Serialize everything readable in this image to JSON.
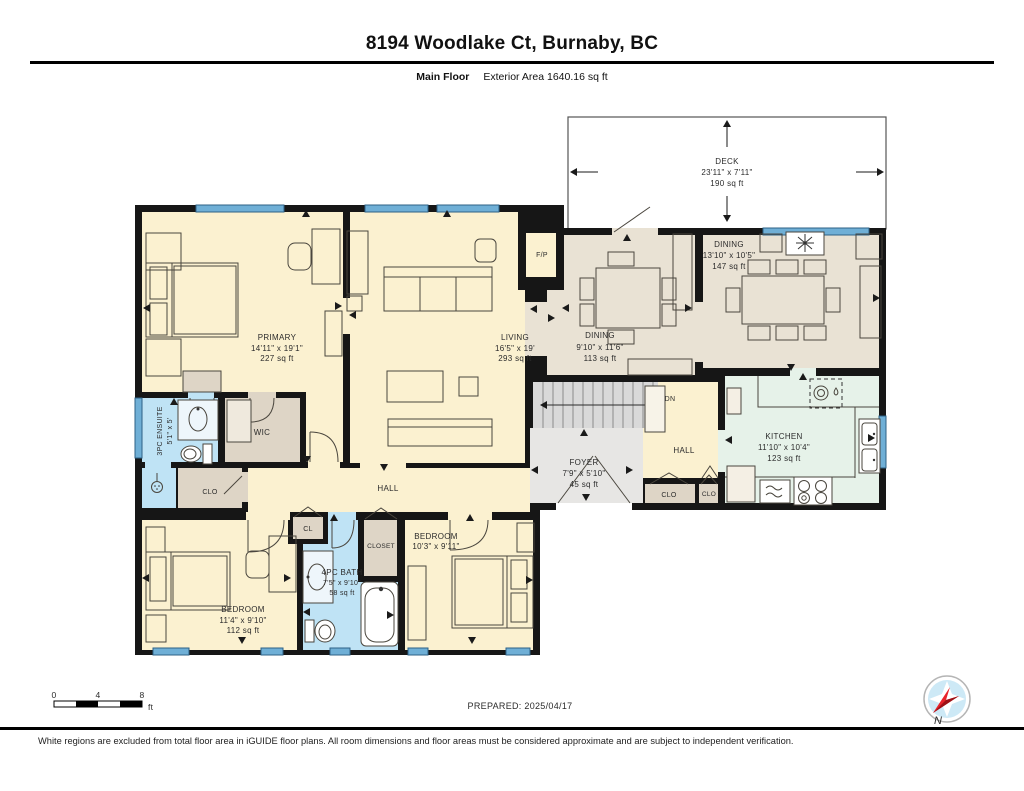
{
  "header": {
    "title": "8194 Woodlake Ct, Burnaby, BC",
    "floor_label": "Main Floor",
    "area_label": "Exterior Area 1640.16 sq ft"
  },
  "rooms": {
    "deck": {
      "name": "DECK",
      "dims": "23'11\" x 7'11\"",
      "area": "190 sq ft"
    },
    "primary": {
      "name": "PRIMARY",
      "dims": "14'11\" x 19'1\"",
      "area": "227 sq ft"
    },
    "living": {
      "name": "LIVING",
      "dims": "16'5\" x 19'",
      "area": "293 sq ft"
    },
    "dining_small": {
      "name": "DINING",
      "dims": "9'10\" x 11'6\"",
      "area": "113 sq ft"
    },
    "dining_large": {
      "name": "DINING",
      "dims": "13'10\" x 10'5\"",
      "area": "147 sq ft"
    },
    "kitchen": {
      "name": "KITCHEN",
      "dims": "11'10\" x 10'4\"",
      "area": "123 sq ft"
    },
    "foyer": {
      "name": "FOYER",
      "dims": "7'9\" x 5'10\"",
      "area": "45 sq ft"
    },
    "bedroom_left": {
      "name": "BEDROOM",
      "dims": "11'4\" x 9'10\"",
      "area": "112 sq ft"
    },
    "bedroom_right": {
      "name": "BEDROOM",
      "dims": "10'3\" x 9'11\""
    },
    "bath": {
      "name": "4PC BATH",
      "dims": "7'5\" x 9'10\"",
      "area": "58 sq ft"
    },
    "ensuite": {
      "name": "3PC ENSUITE",
      "dims": "5'1\" x 5'"
    },
    "wic": {
      "name": "WIC"
    },
    "hall_main": {
      "name": "HALL"
    },
    "hall_right": {
      "name": "HALL"
    },
    "clo_left": {
      "name": "CLO"
    },
    "clo_a": {
      "name": "CLO"
    },
    "clo_b": {
      "name": "CLO"
    },
    "cl": {
      "name": "CL"
    },
    "closet": {
      "name": "CLOSET"
    },
    "fireplace": {
      "name": "F/P"
    },
    "stairs": {
      "dn_label": "DN"
    }
  },
  "scale_bar": {
    "t0": "0",
    "t4": "4",
    "t8": "8",
    "unit": "ft"
  },
  "prepared_label": "PREPARED: 2025/04/17",
  "compass": {
    "north": "N"
  },
  "footer": {
    "disclaimer": "White regions are excluded from total floor area in iGUIDE floor plans. All room dimensions and floor areas must be considered approximate and are subject to independent verification."
  },
  "colors": {
    "wall": "#161616",
    "room_cream": "#FBF1D0",
    "room_greige": "#E9E2D4",
    "room_mint": "#E6F2E9",
    "room_blue": "#BFE3F5",
    "room_tan": "#DED5C6",
    "excluded_gray": "#E7E6E4",
    "stairs_gray": "#D9D9D9",
    "window_blue": "#6FAFD6",
    "compass_red": "#E8232B"
  }
}
